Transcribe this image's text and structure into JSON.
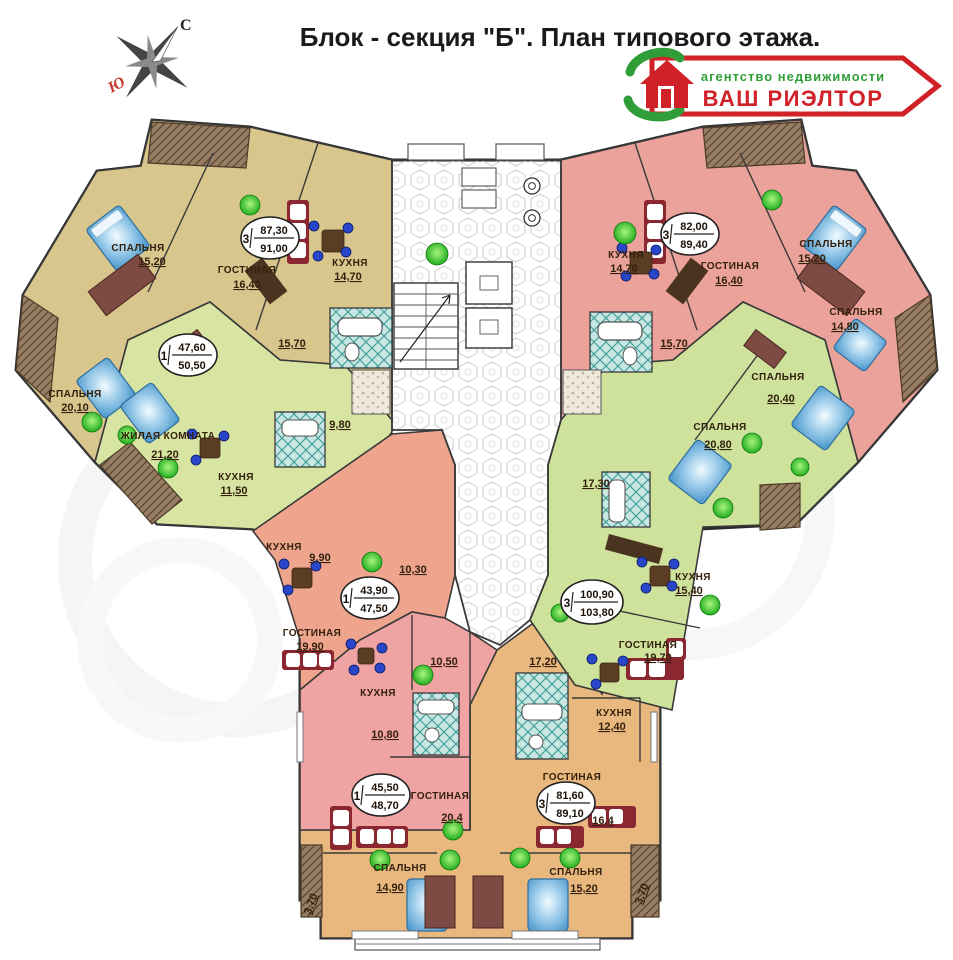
{
  "title": "Блок - секция \"Б\". План типового этажа.",
  "compass": {
    "north": "С",
    "south": "Ю"
  },
  "logo": {
    "line1": "агентство недвижимости",
    "line2": "ВАШ РИЭЛТОР",
    "red": "#cf2127",
    "green": "#2f9e38"
  },
  "colors": {
    "apt_left_top": "#d9c68c",
    "apt_left_mid": "#d8e4a2",
    "apt_right_top": "#eba29a",
    "apt_right_mid": "#cfe29c",
    "apt_center_left": "#efa58d",
    "apt_bottom_left": "#f0a3a3",
    "apt_bottom_right": "#e8b87e",
    "corridor": "#ffffff",
    "wall": "#333333"
  },
  "apartments": {
    "left_top": {
      "oval": {
        "count": "3",
        "upper": "87,30",
        "lower": "91,00"
      },
      "rooms": {
        "bedroom1": {
          "name": "СПАЛЬНЯ",
          "area": "15,20"
        },
        "living": {
          "name": "ГОСТИНАЯ",
          "area": "16,40"
        },
        "kitchen": {
          "name": "КУХНЯ",
          "area": "14,70"
        },
        "bedroom2": {
          "name": "СПАЛЬНЯ",
          "area": "20,10"
        },
        "hall": {
          "area": "15,70"
        }
      }
    },
    "left_mid": {
      "oval": {
        "count": "1",
        "upper": "47,60",
        "lower": "50,50"
      },
      "rooms": {
        "living": {
          "name": "ЖИЛАЯ КОМНАТА",
          "area": "21,20"
        },
        "kitchen": {
          "name": "КУХНЯ",
          "area": "11,50"
        },
        "hall": {
          "area": "9,80"
        }
      }
    },
    "right_top": {
      "oval": {
        "count": "3",
        "upper": "82,00",
        "lower": "89,40"
      },
      "rooms": {
        "kitchen": {
          "name": "КУХНЯ",
          "area": "14,70"
        },
        "living": {
          "name": "ГОСТИНАЯ",
          "area": "16,40"
        },
        "bedroom1": {
          "name": "СПАЛЬНЯ",
          "area": "15,20"
        },
        "bedroom2": {
          "name": "СПАЛЬНЯ",
          "area": "14,80"
        },
        "hall": {
          "area": "15,70"
        }
      }
    },
    "right_mid": {
      "oval": {
        "count": "3",
        "upper": "100,90",
        "lower": "103,80"
      },
      "rooms": {
        "bedroom1": {
          "name": "СПАЛЬНЯ",
          "area": "20,40"
        },
        "bedroom2": {
          "name": "СПАЛЬНЯ",
          "area": "20,80"
        },
        "kitchen": {
          "name": "КУХНЯ",
          "area": "15,40"
        },
        "living": {
          "name": "ГОСТИНАЯ",
          "area": "19,70"
        },
        "hall": {
          "area": "17,30"
        }
      }
    },
    "center_left": {
      "oval": {
        "count": "1",
        "upper": "43,90",
        "lower": "47,50"
      },
      "rooms": {
        "kitchen": {
          "name": "КУХНЯ",
          "area": "9,90"
        },
        "living": {
          "name": "ГОСТИНАЯ",
          "area": "19,90"
        },
        "hall": {
          "area": "10,30"
        }
      }
    },
    "bottom_left": {
      "oval": {
        "count": "1",
        "upper": "45,50",
        "lower": "48,70"
      },
      "rooms": {
        "kitchen": {
          "name": "КУХНЯ",
          "area": "10,80"
        },
        "living": {
          "name": "ГОСТИНАЯ",
          "area": "20,4"
        },
        "hall": {
          "area": "10,50"
        }
      }
    },
    "bottom_right": {
      "oval": {
        "count": "3",
        "upper": "81,60",
        "lower": "89,10"
      },
      "rooms": {
        "living": {
          "name": "ГОСТИНАЯ",
          "area": "16,4"
        },
        "kitchen": {
          "name": "КУХНЯ",
          "area": "12,40"
        },
        "bedroom1": {
          "name": "СПАЛЬНЯ",
          "area": "14,90"
        },
        "bedroom2": {
          "name": "СПАЛЬНЯ",
          "area": "15,20"
        },
        "hall": {
          "area": "17,20"
        }
      }
    }
  },
  "balconies": {
    "left": "3,70",
    "right": "3,70"
  }
}
